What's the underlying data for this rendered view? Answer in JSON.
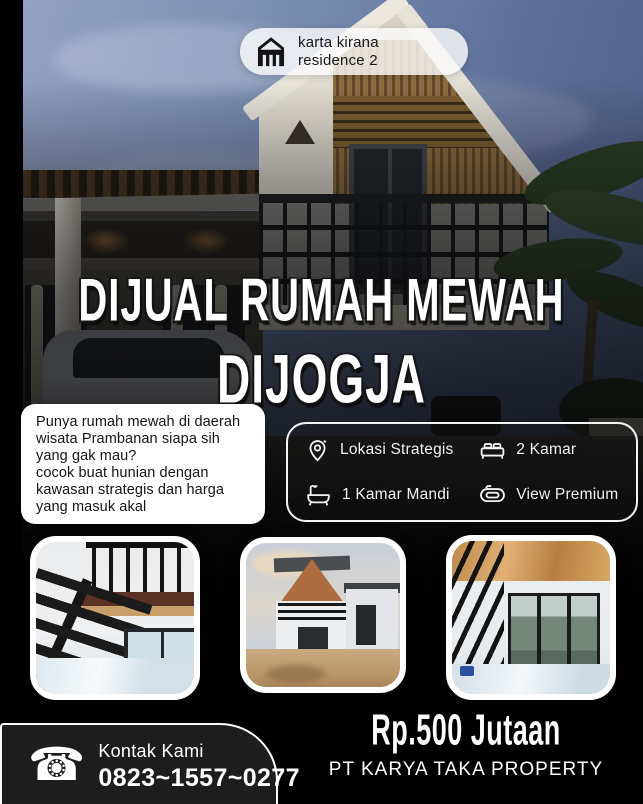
{
  "badge": {
    "line1": "karta kirana",
    "line2": "residence 2"
  },
  "title": {
    "line1": "DIJUAL RUMAH MEWAH",
    "line2": "DIJOGJA"
  },
  "description": {
    "text": "Punya rumah mewah di daerah\nwisata Prambanan siapa sih\nyang gak mau?\ncocok buat hunian dengan\nkawasan strategis dan harga\nyang masuk akal"
  },
  "features": {
    "items": [
      {
        "icon": "location-pin-icon",
        "label": "Lokasi Strategis"
      },
      {
        "icon": "bed-icon",
        "label": "2 Kamar"
      },
      {
        "icon": "bathtub-icon",
        "label": "1 Kamar Mandi"
      },
      {
        "icon": "view-premium-icon",
        "label": "View Premium"
      }
    ]
  },
  "gallery": {
    "photos": [
      {
        "name": "interior-mezzanine-stairs-photo"
      },
      {
        "name": "house-exterior-courtyard-photo"
      },
      {
        "name": "interior-glass-door-photo"
      }
    ]
  },
  "footer": {
    "contact_label": "Kontak Kami",
    "phone_number": "0823~1557~0277",
    "price": "Rp.500 Jutaan",
    "company": "PT KARYA TAKA PROPERTY"
  },
  "colors": {
    "background": "#000000",
    "text_light": "#ffffff",
    "text_dark": "#141414",
    "card_bg": "#ffffff",
    "panel_border": "#f4f4f4",
    "sky_blue": "#7c90b4"
  }
}
